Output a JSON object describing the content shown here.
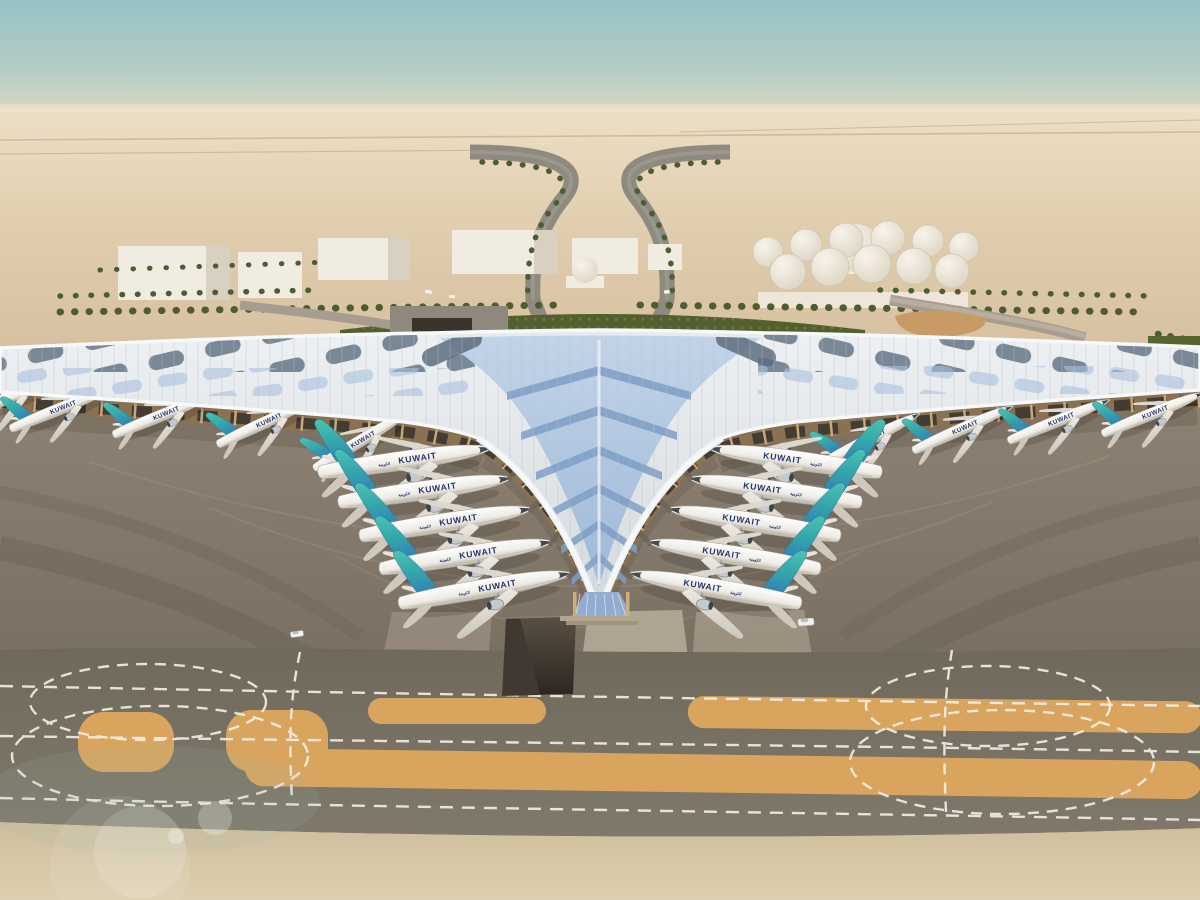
{
  "airline": {
    "label": "KUWAIT",
    "arabic_label": "الكويتية",
    "tail_teal": "#4cc4b4",
    "tail_mid": "#35a8ab",
    "tail_blue": "#2f79b8",
    "title_color": "#23356e"
  },
  "aircraft_counts": {
    "left_concourse": 5,
    "right_concourse": 5,
    "left_pier": 5,
    "right_pier": 4
  },
  "colors": {
    "sky_top": "#95c1c6",
    "sky_mid": "#b7cdc6",
    "sky_haze": "#e9dcc2",
    "desert_far": "#ecdfc6",
    "desert_near": "#d6c0a0",
    "sand_foreground": "#d5c3a2",
    "apron": "#8d8172",
    "taxiway": "#767060",
    "taxiway_marking": "#f2efe6",
    "sand_strip": "#d9a55e",
    "roof_white": "#eef1f3",
    "roof_rib": "#b9c0c7",
    "roof_glass_light": "#c3d4e8",
    "roof_glass": "#9db9d9",
    "roof_chevron": "#7e9ec6",
    "roof_panel_dark": "#5d6e80",
    "facade_tan": "#cfae7e",
    "landscape_green": "#52602f",
    "palm_green": "#4d5c31",
    "building_white": "#f1ece1",
    "tank_white": "#efe9dd",
    "tunnel_dark": "#403931",
    "vehicle_white": "#f2f1ed"
  }
}
